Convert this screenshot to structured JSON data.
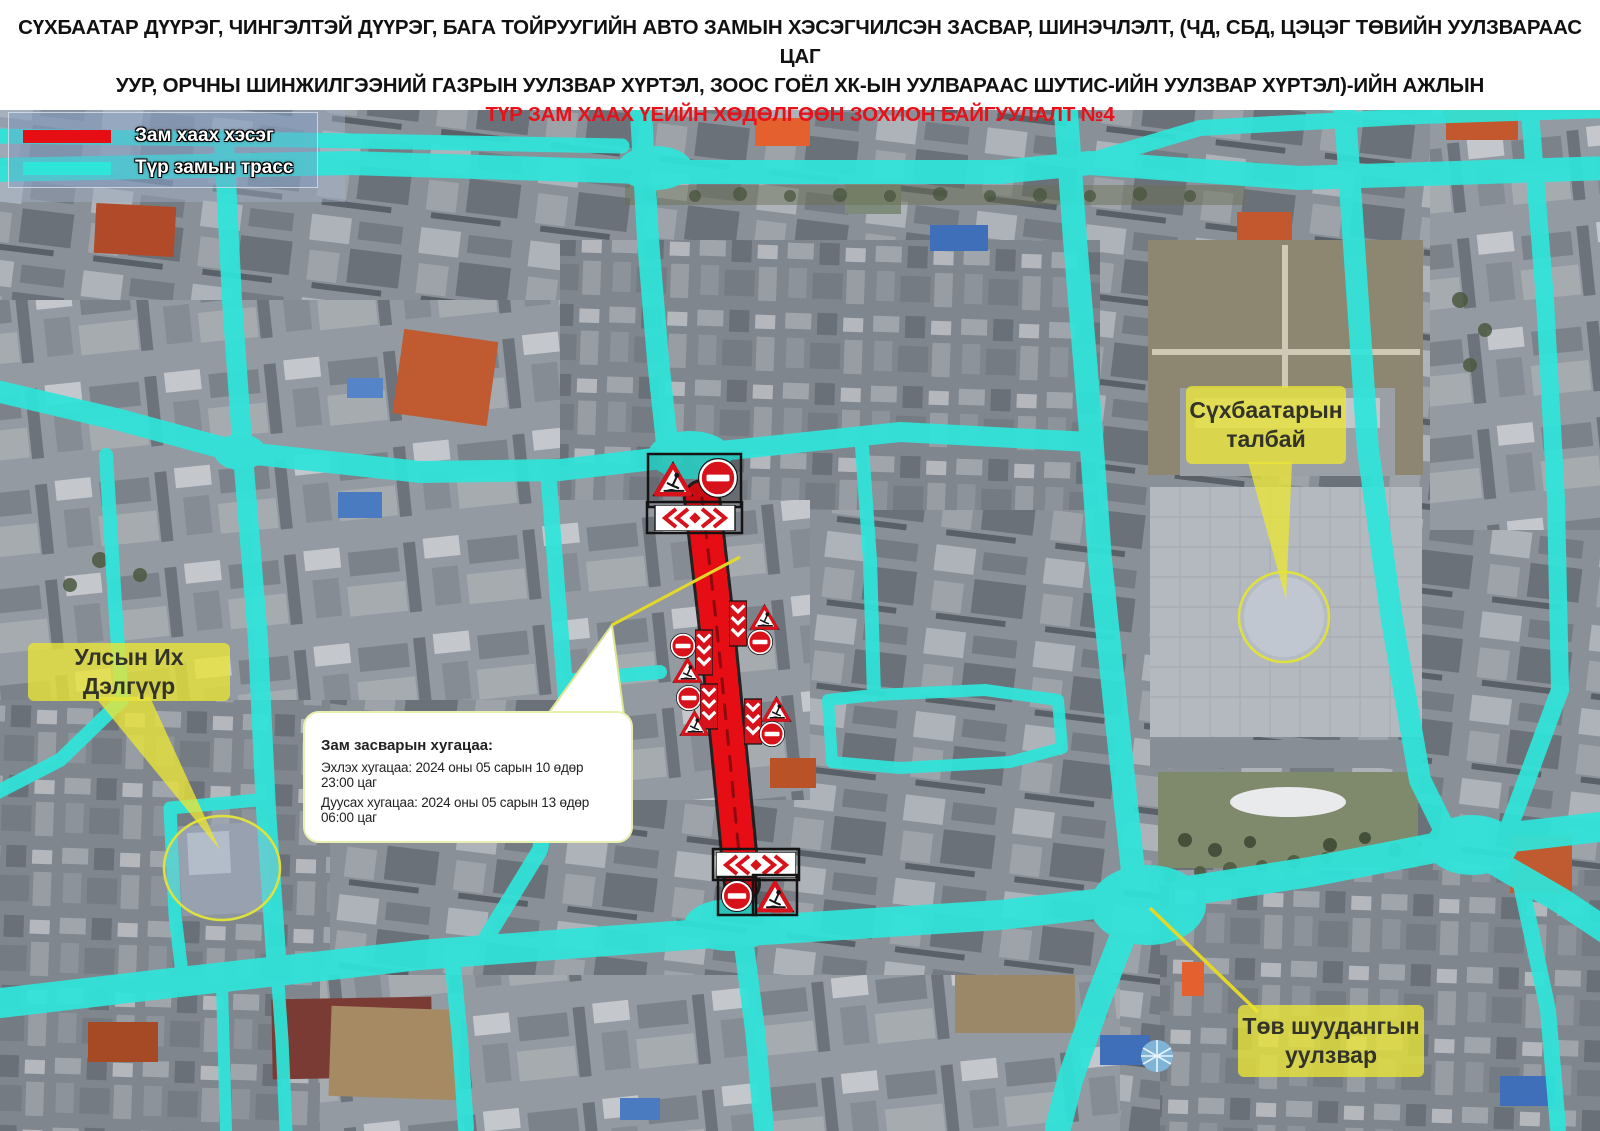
{
  "header": {
    "line1": "СҮХБААТАР  ДҮҮРЭГ, ЧИНГЭЛТЭЙ ДҮҮРЭГ, БАГА ТОЙРУУГИЙН АВТО ЗАМЫН ХЭСЭГЧИЛСЭН ЗАСВАР, ШИНЭЧЛЭЛТ, (ЧД, СБД, ЦЭЦЭГ ТӨВИЙН УУЛЗВАРААС ЦАГ",
    "line2": "УУР, ОРЧНЫ ШИНЖИЛГЭЭНИЙ ГАЗРЫН УУЛЗВАР ХҮРТЭЛ, ЗООС ГОЁЛ ХК-ЫН УУЛВАРААС ШУТИС-ИЙН УУЛЗВАР ХҮРТЭЛ)-ИЙН АЖЛЫН",
    "line3": "ТҮР ЗАМ ХААХ ҮЕИЙН ХӨДӨЛГӨӨН ЗОХИОН БАЙГУУЛАЛТ №4"
  },
  "legend": {
    "items": [
      {
        "label": "Зам хаах хэсэг",
        "color": "#E8101C"
      },
      {
        "label": "Түр замын трасс",
        "color": "#2FE5DA"
      }
    ]
  },
  "labels": {
    "department_store": "Улсын Их Дэлгүүр",
    "square_line1": "Сүхбаатарын",
    "square_line2": "талбай",
    "post_line1": "Төв шуудангын",
    "post_line2": "уулзвар"
  },
  "info_box": {
    "title": "Зам засварын хугацаа:",
    "start": "Эхлэх хугацаа: 2024 оны 05 сарын 10 өдөр 23:00 цаг",
    "end": "Дуусах хугацаа: 2024 оны 05 сарын 13 өдөр 06:00 цаг"
  },
  "colors": {
    "header-red": "#E8111A",
    "road-cyan": "#2FE5DA",
    "closed-red": "#E60D15",
    "sign-red": "#D8121B",
    "label-yellow": "#E9E437C9",
    "callout-yellow": "#E3D82A"
  }
}
